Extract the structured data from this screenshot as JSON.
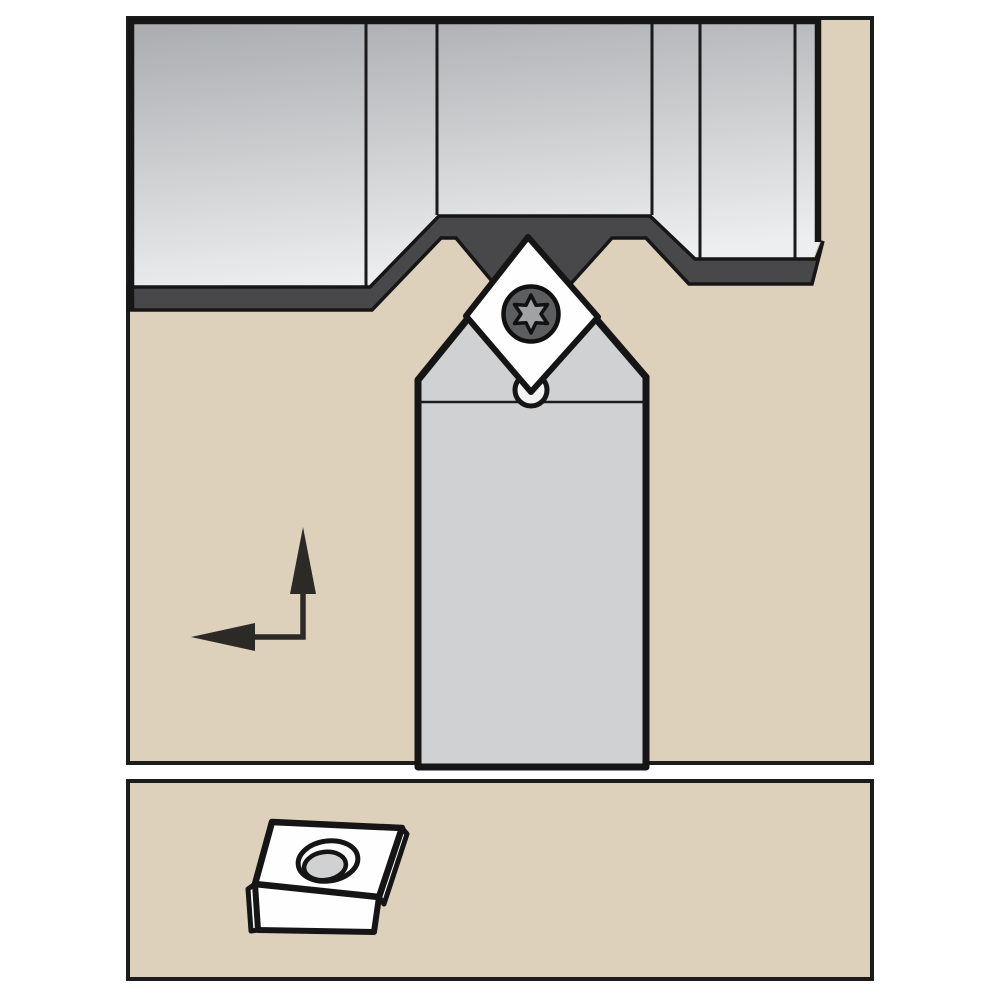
{
  "illustration": {
    "description_name": "turning-toolholder-technical-diagram",
    "palette": {
      "page_bg": "#ffffff",
      "panel_fill": "#ddd1bc",
      "panel_border": "#1b1b1b",
      "workpiece_grad_top": "#a9acae",
      "workpiece_grad_bottom": "#eceeef",
      "machined_band": "#48484a",
      "outline": "#161616",
      "holder_fill": "#cfd1d3",
      "insert_fill": "#fefefe",
      "torx_ring": "#5d5e60",
      "torx_star": "#a0a2a4",
      "arrow": "#2b2a27"
    },
    "shapes": [
      {
        "name": "top-panel",
        "tag": "rect",
        "attrs": {
          "x": 128,
          "y": 18,
          "width": 744,
          "height": 745,
          "fill": "#ddd1bc",
          "stroke": "#1b1b1b",
          "stroke-width": 4
        }
      },
      {
        "name": "bottom-panel",
        "tag": "rect",
        "attrs": {
          "x": 128,
          "y": 781,
          "width": 744,
          "height": 198,
          "fill": "#ddd1bc",
          "stroke": "#1b1b1b",
          "stroke-width": 4
        }
      },
      {
        "name": "workpiece-body",
        "tag": "polygon",
        "attrs": {
          "points": "131,21 819,21 819,243 812,261 696,261 651,216 438,216 370,288 131,288",
          "fill": "url(#wpGrad)"
        }
      },
      {
        "name": "workpiece-section-divider",
        "tag": "line",
        "attrs": {
          "x1": 366,
          "y1": 21,
          "x2": 366,
          "y2": 286,
          "stroke": "#1a1a1a",
          "stroke-width": 3
        }
      },
      {
        "name": "workpiece-section-divider",
        "tag": "line",
        "attrs": {
          "x1": 437,
          "y1": 21,
          "x2": 437,
          "y2": 215,
          "stroke": "#1a1a1a",
          "stroke-width": 3
        }
      },
      {
        "name": "workpiece-section-divider",
        "tag": "line",
        "attrs": {
          "x1": 652,
          "y1": 21,
          "x2": 652,
          "y2": 215,
          "stroke": "#1a1a1a",
          "stroke-width": 3
        }
      },
      {
        "name": "workpiece-section-divider",
        "tag": "line",
        "attrs": {
          "x1": 700,
          "y1": 21,
          "x2": 700,
          "y2": 259,
          "stroke": "#1a1a1a",
          "stroke-width": 3
        }
      },
      {
        "name": "workpiece-section-divider",
        "tag": "line",
        "attrs": {
          "x1": 795,
          "y1": 21,
          "x2": 795,
          "y2": 259,
          "stroke": "#1a1a1a",
          "stroke-width": 3
        }
      },
      {
        "name": "machined-surface-band",
        "tag": "polygon",
        "attrs": {
          "points": "128,287 370,287 439,216 650,216 695,259 816,259 823,241 812,284 689,284 646,238 612,238 531,328 456,238 441,238 372,310 128,310",
          "fill": "#48484a",
          "stroke": "#161616",
          "stroke-width": 3.5
        }
      },
      {
        "name": "workpiece-outline",
        "tag": "path",
        "attrs": {
          "d": "M131,311 L131,21 L818,21 L818,242",
          "fill": "none",
          "stroke": "#161616",
          "stroke-width": 6.5
        }
      },
      {
        "name": "toolholder-body",
        "tag": "polygon",
        "attrs": {
          "points": "418,767 418,380 530,242 646,377 646,767",
          "fill": "#cfd1d3",
          "stroke": "#151515",
          "stroke-width": 7,
          "stroke-linejoin": "round"
        }
      },
      {
        "name": "toolholder-head-line",
        "tag": "line",
        "attrs": {
          "x1": 418,
          "y1": 402,
          "x2": 646,
          "y2": 402,
          "stroke": "#1c1c1c",
          "stroke-width": 2.5
        }
      },
      {
        "name": "clamp-screw-tip",
        "tag": "circle",
        "attrs": {
          "cx": 531,
          "cy": 390,
          "r": 16,
          "fill": "#f3f3f3",
          "stroke": "#151515",
          "stroke-width": 5
        }
      },
      {
        "name": "diamond-insert",
        "tag": "polygon",
        "attrs": {
          "points": "528,237 598,317 531,392 466,316",
          "fill": "#fefefe",
          "stroke": "#151515",
          "stroke-width": 6,
          "stroke-linejoin": "round"
        }
      },
      {
        "name": "torx-screw-icon",
        "tag": "circle",
        "attrs": {
          "cx": 531,
          "cy": 314,
          "r": 27.5,
          "fill": "#5d5e60",
          "stroke": "#101010",
          "stroke-width": 4.5
        }
      },
      {
        "name": "torx-star-icon",
        "tag": "path",
        "attrs": {
          "d": "M531,295 L536,305.3 L547.5,304.5 L541,314 L547.5,323.5 L536,322.7 L531,333 L526,322.7 L514.5,323.5 L521,314 L514.5,304.5 L526,305.3 Z",
          "fill": "#a0a2a4",
          "stroke": "#111111",
          "stroke-width": 3.5,
          "stroke-linejoin": "round"
        }
      },
      {
        "name": "feed-direction-arrow",
        "tag": "path",
        "attrs": {
          "d": "M303,592 L303,637 L253,637",
          "fill": "none",
          "stroke": "#2b2a27",
          "stroke-width": 5.5
        }
      },
      {
        "name": "arrow-up-head",
        "tag": "polygon",
        "attrs": {
          "points": "290,594 316,594 303,527",
          "fill": "#2b2a27"
        }
      },
      {
        "name": "arrow-left-head",
        "tag": "polygon",
        "attrs": {
          "points": "255,623 255,651 191,637",
          "fill": "#2b2a27"
        }
      },
      {
        "name": "insert-3d-left-facet",
        "tag": "polygon",
        "attrs": {
          "points": "255,884 248,889 251,931 258,930",
          "fill": "#fefefe",
          "stroke": "#151515",
          "stroke-width": 5,
          "stroke-linejoin": "round"
        }
      },
      {
        "name": "insert-3d-right-facet",
        "tag": "polygon",
        "attrs": {
          "points": "379,897 402,828 407,834 384,904",
          "fill": "#fefefe",
          "stroke": "#151515",
          "stroke-width": 5,
          "stroke-linejoin": "round"
        }
      },
      {
        "name": "insert-3d-front-face",
        "tag": "polygon",
        "attrs": {
          "points": "255,884 379,897 374,932 258,930",
          "fill": "#fefefe",
          "stroke": "#151515",
          "stroke-width": 6,
          "stroke-linejoin": "round"
        }
      },
      {
        "name": "insert-3d-top-face",
        "tag": "polygon",
        "attrs": {
          "points": "272,822 402,828 379,897 255,884",
          "fill": "#fefefe",
          "stroke": "#151515",
          "stroke-width": 6.5,
          "stroke-linejoin": "round"
        }
      },
      {
        "name": "insert-hole-rim",
        "tag": "ellipse",
        "attrs": {
          "cx": 328,
          "cy": 861,
          "rx": 30,
          "ry": 20,
          "transform": "rotate(-8 328 861)",
          "fill": "#fefefe",
          "stroke": "#151515",
          "stroke-width": 5
        }
      },
      {
        "name": "insert-hole-bore",
        "tag": "ellipse",
        "attrs": {
          "cx": 325,
          "cy": 866,
          "rx": 21,
          "ry": 14,
          "transform": "rotate(-8 325 866)",
          "fill": "#cfd1d3",
          "stroke": "#151515",
          "stroke-width": 4.5
        }
      }
    ]
  }
}
